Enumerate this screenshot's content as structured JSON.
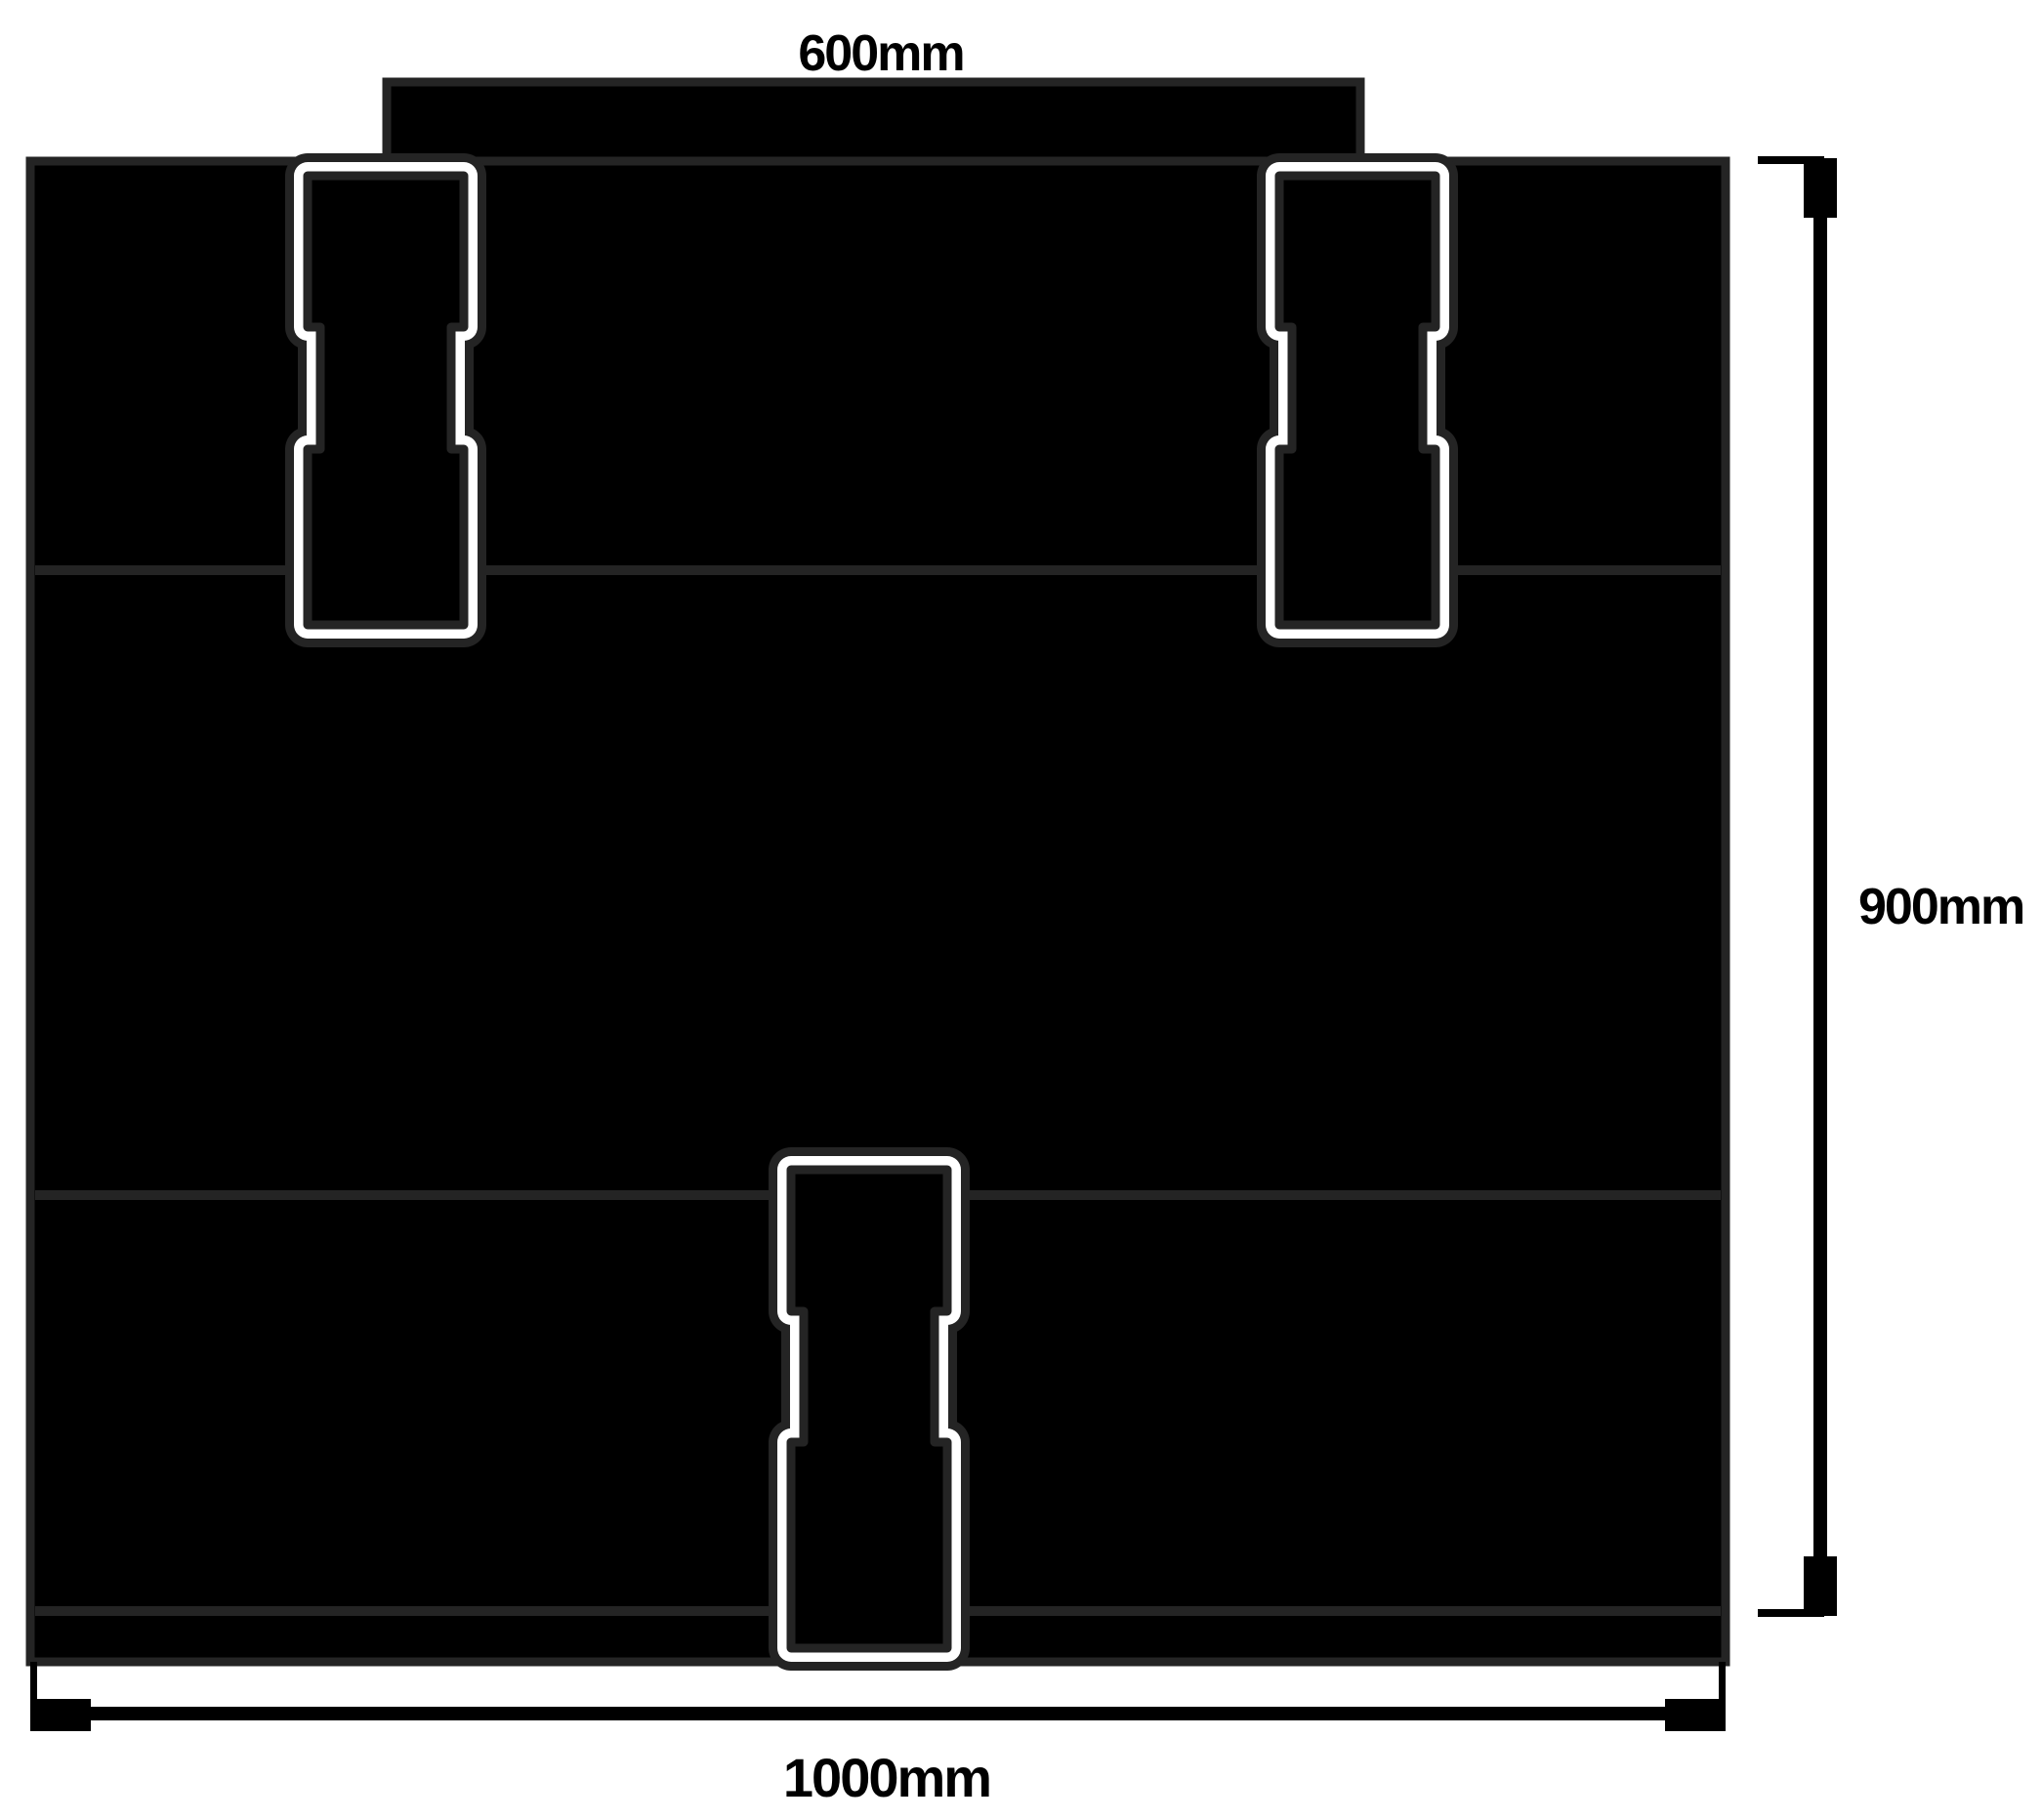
{
  "diagram": {
    "description": "technical dimension drawing of a panel kit with top rail tab, three boards, bottom rail and three connector clips",
    "dimensions": {
      "top_width_label": "600mm",
      "height_label": "900mm",
      "bottom_width_label": "1000mm"
    },
    "colors": {
      "background": "#ffffff",
      "shape_fill": "#000000",
      "outline_ink": "#242424",
      "clip_gap": "#ffffff",
      "label_ink": "#000000"
    }
  }
}
